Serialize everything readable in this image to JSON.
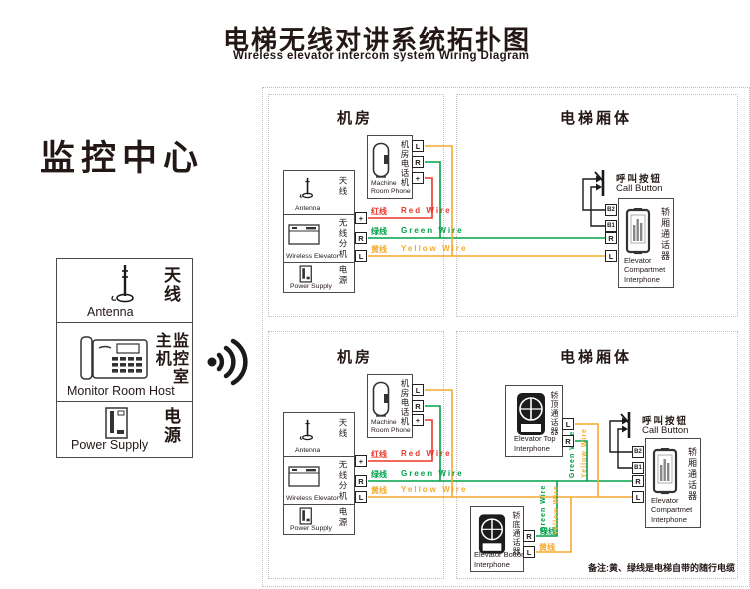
{
  "title": {
    "zh": "电梯无线对讲系统拓扑图",
    "en": "Wireless elevator intercom system Wiring Diagram"
  },
  "monitor_center": {
    "heading": "监控中心",
    "antenna": {
      "zh": "天线",
      "en": "Antenna"
    },
    "host": {
      "zh": "监控室主机",
      "en": "Monitor Room Host"
    },
    "power": {
      "zh": "电源",
      "en": "Power Supply"
    }
  },
  "section_headers": {
    "machine_room": "机房",
    "elevator_car": "电梯厢体"
  },
  "machine_room": {
    "antenna": {
      "zh": "天线",
      "en": "Antenna"
    },
    "wireless_unit": {
      "zh": "无线分机",
      "en": "Wireless Elevator"
    },
    "power": {
      "zh": "电源",
      "en": "Power Supply"
    },
    "phone": {
      "zh": "机房电话机",
      "en1": "Machine",
      "en2": "Room Phone"
    }
  },
  "elevator": {
    "call_button": {
      "zh": "呼叫按钮",
      "en": "Call Button"
    },
    "compartment_interphone": {
      "zh": "轿厢通话器",
      "en1": "Elevator",
      "en2": "Compartmet",
      "en3": "Interphone"
    },
    "top_interphone": {
      "zh": "轿顶通话器",
      "en1": "Elevator Top",
      "en2": "Interphone"
    },
    "bottom_interphone": {
      "zh": "轿底通话器",
      "en1": "Elevator Bottom",
      "en2": "Interphone"
    }
  },
  "terminals": {
    "plus": "+",
    "r": "R",
    "l": "L",
    "b2": "B2",
    "b1": "B1"
  },
  "wires": {
    "red": {
      "zh": "红线",
      "en": "Red Wire",
      "color": "#e8382d"
    },
    "green": {
      "zh": "绿线",
      "en": "Green Wire",
      "color": "#00a049"
    },
    "yellow": {
      "zh": "黄线",
      "en": "Yellow Wire",
      "color": "#f5a92d"
    }
  },
  "note": "备注:黄、绿线是电梯自带的随行电缆"
}
